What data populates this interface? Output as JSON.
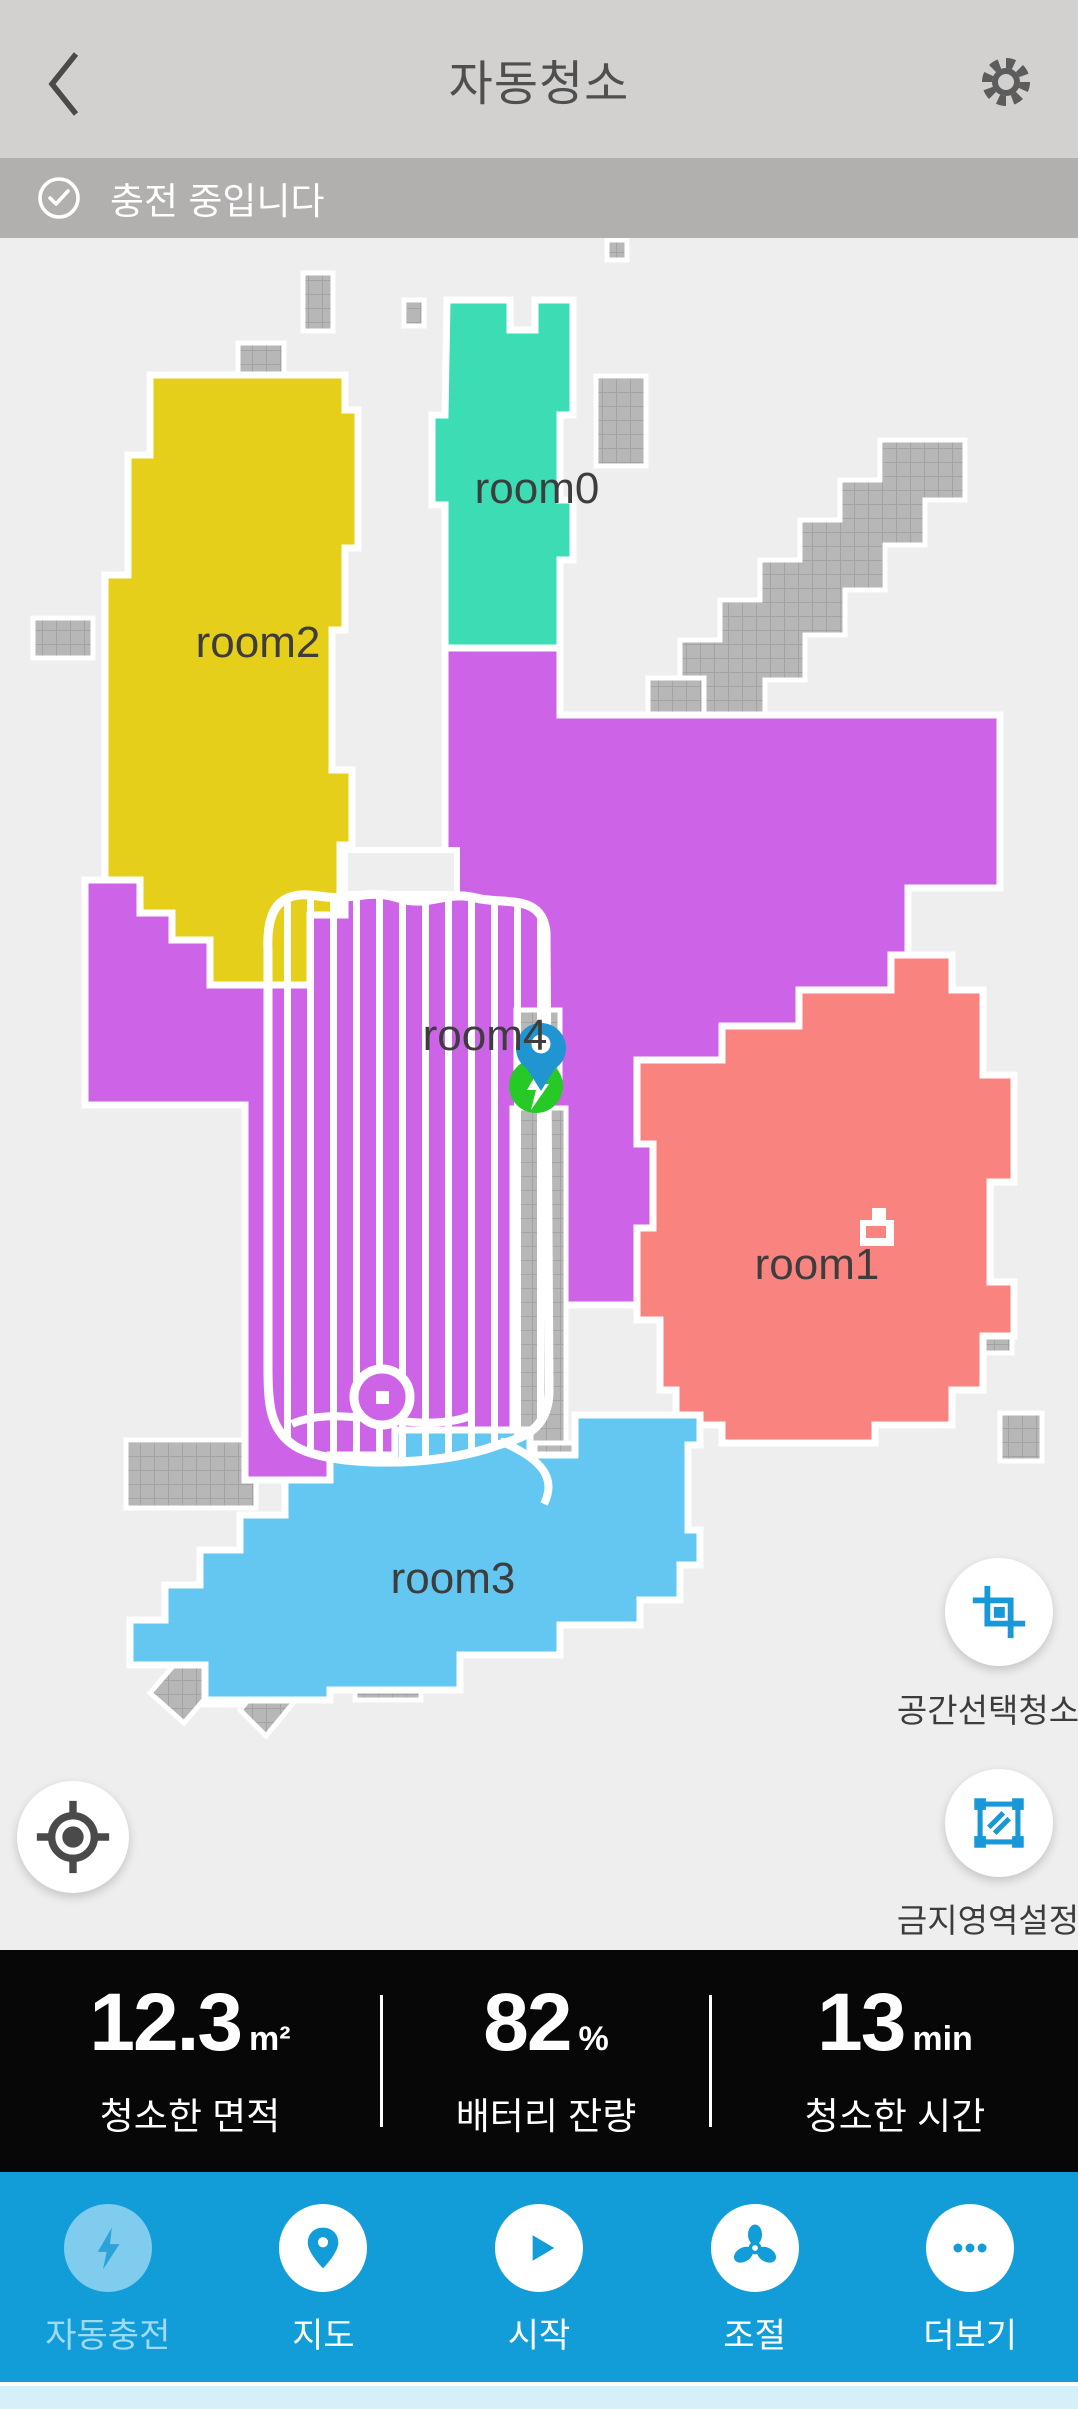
{
  "header": {
    "title": "자동청소"
  },
  "status_bar": {
    "message": "충전 중입니다"
  },
  "map": {
    "rooms": [
      {
        "id": "room0",
        "label": "room0",
        "color": "#3cdcb5"
      },
      {
        "id": "room1",
        "label": "room1",
        "color": "#f9837e"
      },
      {
        "id": "room2",
        "label": "room2",
        "color": "#e5cf1b"
      },
      {
        "id": "room3",
        "label": "room3",
        "color": "#63c7f1"
      },
      {
        "id": "room4",
        "label": "room4",
        "color": "#cd63e6"
      }
    ]
  },
  "side_controls": {
    "area_clean_label": "공간선택청소",
    "no_go_label": "금지영역설정"
  },
  "stats": {
    "items": [
      {
        "value": "12.3",
        "unit": "m²",
        "label": "청소한 면적"
      },
      {
        "value": "82",
        "unit": "%",
        "label": "배터리 잔량"
      },
      {
        "value": "13",
        "unit": "min",
        "label": "청소한 시간"
      }
    ]
  },
  "nav": {
    "items": [
      {
        "label": "자동충전",
        "icon": "bolt-icon",
        "disabled": true
      },
      {
        "label": "지도",
        "icon": "map-pin-icon",
        "disabled": false
      },
      {
        "label": "시작",
        "icon": "play-icon",
        "disabled": false
      },
      {
        "label": "조절",
        "icon": "fan-icon",
        "disabled": false
      },
      {
        "label": "더보기",
        "icon": "more-icon",
        "disabled": false
      }
    ]
  },
  "colors": {
    "header_bg": "#d3d1d0",
    "status_bg": "#b1b0af",
    "map_bg": "#efeeee",
    "obstacle_gray": "#b7b7b7",
    "stats_bg": "#070707",
    "nav_bg": "#129dd9",
    "accent_blue": "#1898d8",
    "robot_pin_blue": "#2095d2",
    "dock_green": "#27c927"
  }
}
